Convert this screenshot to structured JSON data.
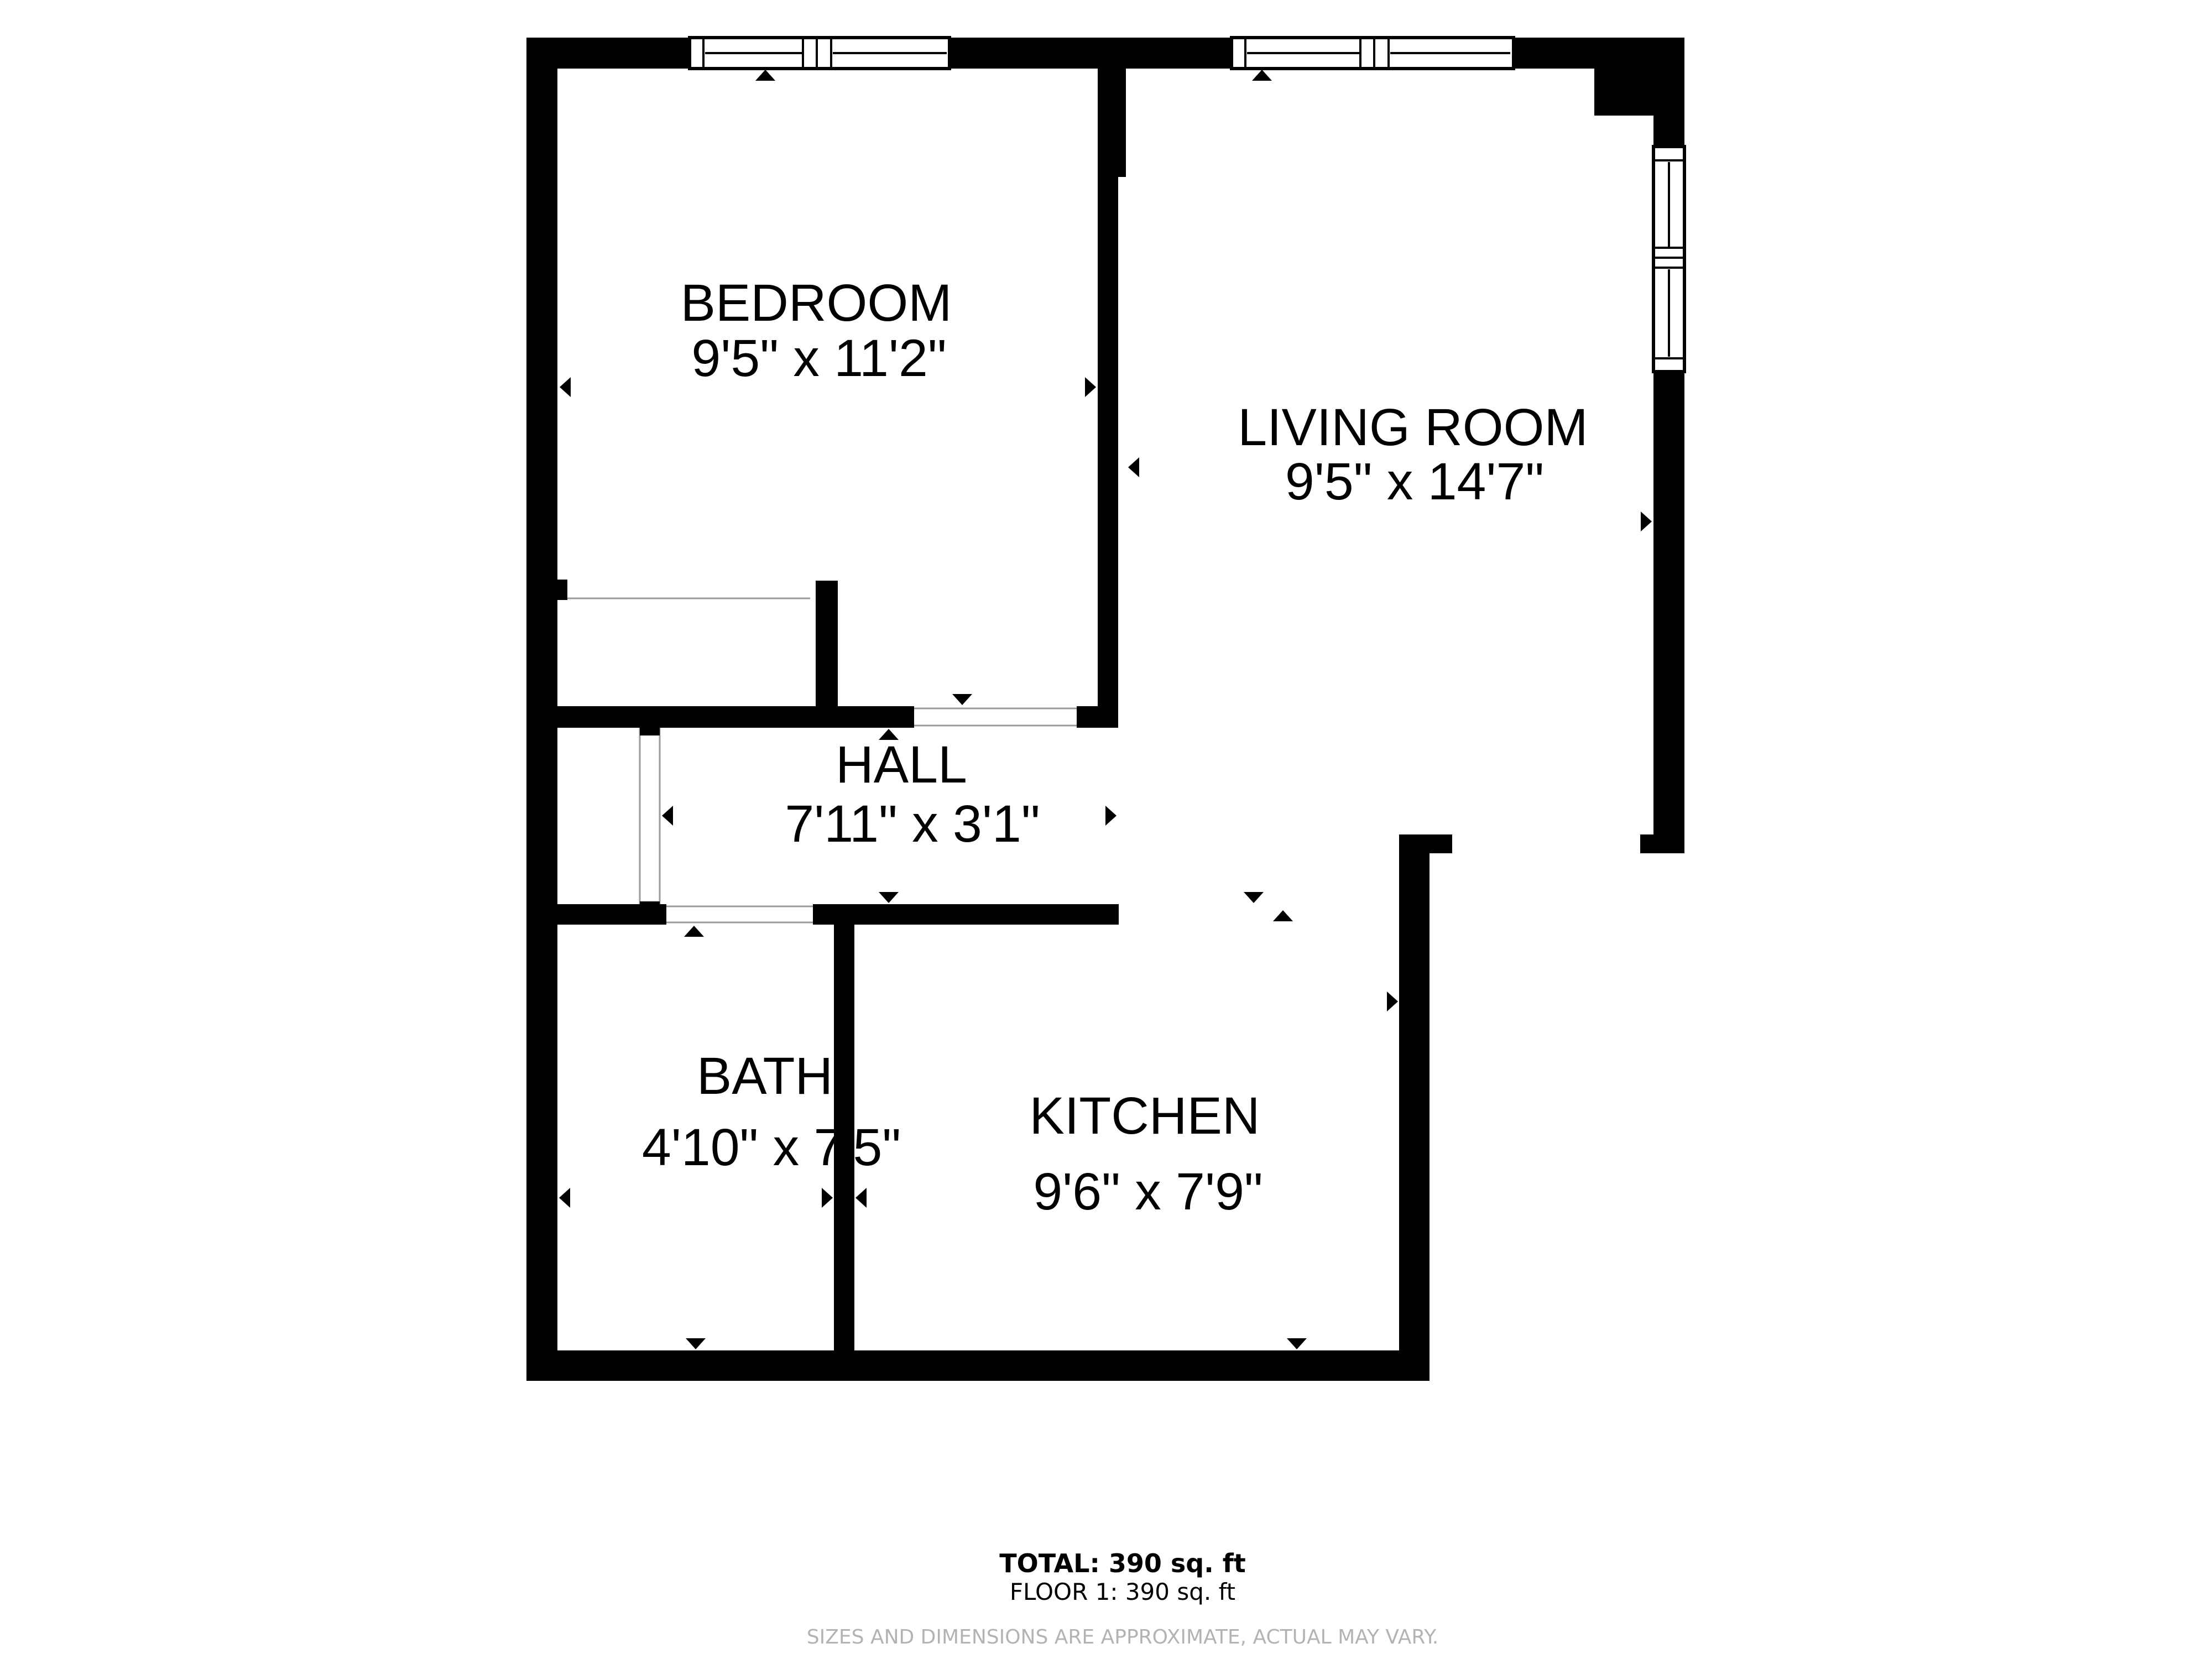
{
  "plan": {
    "type": "floor-plan",
    "rooms": [
      {
        "id": "bedroom",
        "name": "BEDROOM",
        "dims": "9'5\" x 11'2\""
      },
      {
        "id": "living-room",
        "name": "LIVING ROOM",
        "dims": "9'5\" x 14'7\""
      },
      {
        "id": "hall",
        "name": "HALL",
        "dims": "7'11\" x 3'1\""
      },
      {
        "id": "bath",
        "name": "BATH",
        "dims": "4'10\" x 7'5\""
      },
      {
        "id": "kitchen",
        "name": "KITCHEN",
        "dims": "9'6\" x 7'9\""
      }
    ]
  },
  "summary": {
    "total": "TOTAL: 390 sq. ft",
    "floor": "FLOOR 1: 390 sq. ft"
  },
  "disclaimer": "SIZES AND DIMENSIONS ARE APPROXIMATE, ACTUAL MAY VARY.",
  "colors": {
    "wall": "#000000",
    "background": "#ffffff",
    "threshold": "#9a9a9a",
    "disclaimer_text": "#b3b3b3"
  }
}
